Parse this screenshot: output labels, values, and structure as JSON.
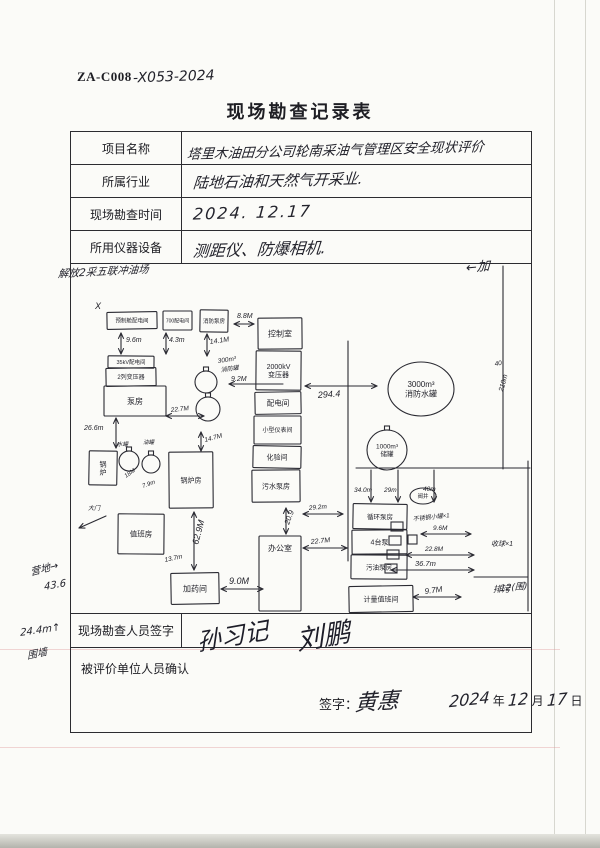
{
  "page": {
    "code_printed": "ZA-C008",
    "code_handwritten": "-X053-2024",
    "title": "现场勘查记录表"
  },
  "form": {
    "rows": [
      {
        "label": "项目名称",
        "value": "塔里木油田分公司轮南采油气管理区安全现状评价"
      },
      {
        "label": "所属行业",
        "value": "陆地石油和天然气开采业."
      },
      {
        "label": "现场勘查时间",
        "value": "2024. 12.17"
      },
      {
        "label": "所用仪器设备",
        "value": "测距仪、防爆相机."
      }
    ],
    "surveyor_row": {
      "label": "现场勘查人员签字",
      "signatures": [
        "孙习记",
        "刘鹏"
      ]
    },
    "confirm_row": {
      "label": "被评价单位人员确认",
      "sign_label": "签字：",
      "sign_name": "黄惠",
      "date": {
        "year": "2024",
        "year_suffix": "年",
        "month": "12",
        "month_suffix": "月",
        "day": "17",
        "day_suffix": "日"
      }
    }
  },
  "sketch": {
    "ink_color": "#2a2a32",
    "boxes": [
      {
        "x": 36,
        "y": 48,
        "w": 50,
        "h": 17,
        "l": [
          "预制舱配电间"
        ],
        "fs": 5.5
      },
      {
        "x": 92,
        "y": 47,
        "w": 29,
        "h": 19,
        "l": [
          "700配电间"
        ],
        "fs": 5
      },
      {
        "x": 129,
        "y": 46,
        "w": 28,
        "h": 22,
        "l": [
          "消防泵房"
        ],
        "fs": 5.5
      },
      {
        "x": 187,
        "y": 54,
        "w": 44,
        "h": 31,
        "l": [
          "控制室"
        ],
        "fs": 8
      },
      {
        "x": 185,
        "y": 87,
        "w": 45,
        "h": 39,
        "l": [
          "2000kV",
          "变压器"
        ],
        "fs": 7
      },
      {
        "x": 184,
        "y": 128,
        "w": 46,
        "h": 22,
        "l": [
          "配电间"
        ],
        "fs": 7.5
      },
      {
        "x": 183,
        "y": 152,
        "w": 47,
        "h": 28,
        "l": [
          "小型仪表间"
        ],
        "fs": 6
      },
      {
        "x": 182,
        "y": 182,
        "w": 48,
        "h": 22,
        "l": [
          "化验间"
        ],
        "fs": 7
      },
      {
        "x": 181,
        "y": 206,
        "w": 48,
        "h": 32,
        "l": [
          "污水泵房"
        ],
        "fs": 7
      },
      {
        "x": 37,
        "y": 92,
        "w": 46,
        "h": 12,
        "l": [
          "35kV配电间"
        ],
        "fs": 5.5
      },
      {
        "x": 35,
        "y": 104,
        "w": 50,
        "h": 18,
        "l": [
          "2列变压器"
        ],
        "fs": 6
      },
      {
        "x": 33,
        "y": 122,
        "w": 62,
        "h": 30,
        "l": [
          "泵房"
        ],
        "fs": 8
      },
      {
        "x": 18,
        "y": 187,
        "w": 28,
        "h": 34,
        "l": [
          "锅",
          "炉"
        ],
        "fs": 7
      },
      {
        "x": 98,
        "y": 188,
        "w": 44,
        "h": 56,
        "l": [
          "锅炉房"
        ],
        "fs": 7
      },
      {
        "x": 47,
        "y": 250,
        "w": 46,
        "h": 40,
        "l": [
          "值班房"
        ],
        "fs": 7.5
      },
      {
        "x": 100,
        "y": 309,
        "w": 48,
        "h": 31,
        "l": [
          "加药间"
        ],
        "fs": 8
      },
      {
        "x": 188,
        "y": 272,
        "w": 42,
        "h": 75,
        "l": [
          "办公室"
        ],
        "fs": 8,
        "ly": 287
      },
      {
        "x": 282,
        "y": 240,
        "w": 54,
        "h": 25,
        "l": [
          "循环泵房"
        ],
        "fs": 6.5
      },
      {
        "x": 281,
        "y": 266,
        "w": 55,
        "h": 24,
        "l": [
          "4台泵"
        ],
        "fs": 7
      },
      {
        "x": 280,
        "y": 291,
        "w": 56,
        "h": 24,
        "l": [
          "污油泵房"
        ],
        "fs": 6.5
      },
      {
        "x": 278,
        "y": 322,
        "w": 64,
        "h": 26,
        "l": [
          "计量值班间"
        ],
        "fs": 7
      }
    ],
    "circles": [
      {
        "cx": 135,
        "cy": 118,
        "r": 11
      },
      {
        "cx": 137,
        "cy": 145,
        "r": 12
      },
      {
        "cx": 58,
        "cy": 197,
        "r": 10
      },
      {
        "cx": 80,
        "cy": 200,
        "r": 9
      },
      {
        "cx": 316,
        "cy": 186,
        "r": 20,
        "l": [
          "1000m³",
          "储罐"
        ],
        "fs": 6.5
      }
    ],
    "ellipses": [
      {
        "cx": 350,
        "cy": 125,
        "rx": 33,
        "ry": 27,
        "l": [
          "3000m³",
          "消防水罐"
        ],
        "fs": 8
      },
      {
        "cx": 352,
        "cy": 232,
        "rx": 13,
        "ry": 8,
        "l": [
          "阀井"
        ],
        "fs": 5.5
      }
    ],
    "squares": [
      {
        "x": 320,
        "y": 258,
        "w": 12,
        "h": 9
      },
      {
        "x": 318,
        "y": 272,
        "w": 12,
        "h": 9
      },
      {
        "x": 316,
        "y": 286,
        "w": 12,
        "h": 9
      },
      {
        "x": 314,
        "y": 300,
        "w": 12,
        "h": 9
      },
      {
        "x": 337,
        "y": 271,
        "w": 9,
        "h": 9
      }
    ],
    "lines": [
      [
        [
          277,
          77
        ],
        [
          277,
          297
        ]
      ],
      [
        [
          285,
          204
        ],
        [
          459,
          204
        ]
      ],
      [
        [
          432,
          2
        ],
        [
          432,
          205
        ]
      ],
      [
        [
          457,
          197
        ],
        [
          457,
          347
        ]
      ],
      [
        [
          403,
          313
        ],
        [
          457,
          313
        ]
      ]
    ],
    "arrows": [
      {
        "x1": 50,
        "y1": 69,
        "x2": 50,
        "y2": 90,
        "h1": 1,
        "h2": 1
      },
      {
        "x1": 95,
        "y1": 69,
        "x2": 95,
        "y2": 90,
        "h1": 1,
        "h2": 1
      },
      {
        "x1": 136,
        "y1": 70,
        "x2": 136,
        "y2": 92,
        "h1": 1,
        "h2": 1
      },
      {
        "x1": 163,
        "y1": 60,
        "x2": 183,
        "y2": 60,
        "h1": 1,
        "h2": 1
      },
      {
        "x1": 212,
        "y1": 120,
        "x2": 158,
        "y2": 120,
        "h1": 0,
        "h2": 1
      },
      {
        "x1": 95,
        "y1": 152,
        "x2": 133,
        "y2": 152,
        "h1": 1,
        "h2": 1
      },
      {
        "x1": 45,
        "y1": 154,
        "x2": 45,
        "y2": 184,
        "h1": 1,
        "h2": 1
      },
      {
        "x1": 130,
        "y1": 168,
        "x2": 130,
        "y2": 187,
        "h1": 1,
        "h2": 1
      },
      {
        "x1": 123,
        "y1": 248,
        "x2": 123,
        "y2": 306,
        "h1": 1,
        "h2": 1
      },
      {
        "x1": 150,
        "y1": 325,
        "x2": 192,
        "y2": 325,
        "h1": 1,
        "h2": 1
      },
      {
        "x1": 215,
        "y1": 244,
        "x2": 215,
        "y2": 270,
        "h1": 1,
        "h2": 1
      },
      {
        "x1": 232,
        "y1": 250,
        "x2": 272,
        "y2": 250,
        "h1": 1,
        "h2": 1
      },
      {
        "x1": 232,
        "y1": 284,
        "x2": 276,
        "y2": 284,
        "h1": 1,
        "h2": 1
      },
      {
        "x1": 234,
        "y1": 122,
        "x2": 306,
        "y2": 122,
        "h1": 1,
        "h2": 1
      },
      {
        "x1": 300,
        "y1": 206,
        "x2": 300,
        "y2": 238,
        "h1": 0,
        "h2": 1
      },
      {
        "x1": 327,
        "y1": 206,
        "x2": 327,
        "y2": 238,
        "h1": 0,
        "h2": 1
      },
      {
        "x1": 363,
        "y1": 206,
        "x2": 363,
        "y2": 238,
        "h1": 0,
        "h2": 1
      },
      {
        "x1": 350,
        "y1": 270,
        "x2": 400,
        "y2": 270,
        "h1": 1,
        "h2": 1
      },
      {
        "x1": 335,
        "y1": 291,
        "x2": 403,
        "y2": 291,
        "h1": 1,
        "h2": 1
      },
      {
        "x1": 320,
        "y1": 306,
        "x2": 403,
        "y2": 306,
        "h1": 1,
        "h2": 1
      },
      {
        "x1": 342,
        "y1": 333,
        "x2": 390,
        "y2": 333,
        "h1": 1,
        "h2": 1
      },
      {
        "x1": 35,
        "y1": 252,
        "x2": 8,
        "y2": 264,
        "h1": 0,
        "h2": 1
      }
    ],
    "dims": [
      {
        "x": 55,
        "y": 78,
        "t": "9.6m",
        "fs": 7,
        "rot": 0
      },
      {
        "x": 98,
        "y": 78,
        "t": "4.3m",
        "fs": 7,
        "rot": 0
      },
      {
        "x": 139,
        "y": 80,
        "t": "14.1M",
        "fs": 7,
        "rot": -8
      },
      {
        "x": 166,
        "y": 54,
        "t": "8.8M",
        "fs": 7,
        "rot": 0
      },
      {
        "x": 147,
        "y": 99,
        "t": "300m³",
        "fs": 6.5,
        "rot": -8
      },
      {
        "x": 150,
        "y": 108,
        "t": "消防罐",
        "fs": 6,
        "rot": -8
      },
      {
        "x": 160,
        "y": 117,
        "t": "9.2M",
        "fs": 7,
        "rot": 0
      },
      {
        "x": 100,
        "y": 148,
        "t": "22.7M",
        "fs": 6.5,
        "rot": -6
      },
      {
        "x": 13,
        "y": 166,
        "t": "26.6m",
        "fs": 7,
        "rot": 0
      },
      {
        "x": 46,
        "y": 182,
        "t": "水罐",
        "fs": 5.5,
        "rot": 0
      },
      {
        "x": 72,
        "y": 180,
        "t": "油罐",
        "fs": 5.5,
        "rot": 0
      },
      {
        "x": 55,
        "y": 214,
        "t": "18M",
        "fs": 6,
        "rot": -35
      },
      {
        "x": 72,
        "y": 224,
        "t": "7.9m",
        "fs": 6,
        "rot": -20
      },
      {
        "x": 134,
        "y": 178,
        "t": "14.7M",
        "fs": 6.5,
        "rot": -15
      },
      {
        "x": 127,
        "y": 281,
        "t": "62.9M",
        "fs": 9,
        "rot": -75
      },
      {
        "x": 94,
        "y": 298,
        "t": "13.7m",
        "fs": 6.5,
        "rot": -12
      },
      {
        "x": 158,
        "y": 320,
        "t": "9.0M",
        "fs": 9,
        "rot": 0
      },
      {
        "x": 218,
        "y": 261,
        "t": "20.9",
        "fs": 7.5,
        "rot": -70
      },
      {
        "x": 238,
        "y": 246,
        "t": "29.2m",
        "fs": 6.5,
        "rot": -5
      },
      {
        "x": 240,
        "y": 280,
        "t": "22.7M",
        "fs": 7,
        "rot": -6
      },
      {
        "x": 247,
        "y": 134,
        "t": "294.4",
        "fs": 9,
        "rot": -4
      },
      {
        "x": 283,
        "y": 228,
        "t": "34.0m",
        "fs": 6.5,
        "rot": 0
      },
      {
        "x": 313,
        "y": 228,
        "t": "29m",
        "fs": 6.5,
        "rot": 0
      },
      {
        "x": 352,
        "y": 227,
        "t": "40m",
        "fs": 6.5,
        "rot": 0
      },
      {
        "x": 342,
        "y": 257,
        "t": "不锈钢小罐×1",
        "fs": 6,
        "rot": -6
      },
      {
        "x": 362,
        "y": 266,
        "t": "9.6M",
        "fs": 6.5,
        "rot": 0
      },
      {
        "x": 354,
        "y": 287,
        "t": "22.8M",
        "fs": 6.5,
        "rot": 0
      },
      {
        "x": 344,
        "y": 302,
        "t": "36.7m",
        "fs": 7.5,
        "rot": 0
      },
      {
        "x": 354,
        "y": 330,
        "t": "9.7M",
        "fs": 8,
        "rot": -8
      },
      {
        "x": 420,
        "y": 282,
        "t": "收球×1",
        "fs": 7,
        "rot": 0
      },
      {
        "x": 422,
        "y": 328,
        "t": "排污",
        "fs": 8.5,
        "rot": 0
      },
      {
        "x": 17,
        "y": 246,
        "t": "大门",
        "fs": 6,
        "rot": 0
      },
      {
        "x": 424,
        "y": 102,
        "t": "40",
        "fs": 6.5,
        "rot": -10
      },
      {
        "x": 432,
        "y": 128,
        "t": "210m",
        "fs": 7,
        "rot": -75
      },
      {
        "x": 24,
        "y": 45,
        "t": "X",
        "fs": 9,
        "rot": 0
      }
    ]
  },
  "margin_notes": [
    {
      "x": 58,
      "y": 264,
      "t": "解放2采五联冲油场",
      "fs": 10.5,
      "rot": -3
    },
    {
      "x": 30,
      "y": 560,
      "t": "营地→",
      "fs": 10,
      "rot": -15
    },
    {
      "x": 44,
      "y": 580,
      "t": "43.6",
      "fs": 10,
      "rot": -10
    },
    {
      "x": 20,
      "y": 625,
      "t": "24.4m↑",
      "fs": 10,
      "rot": -8
    },
    {
      "x": 27,
      "y": 645,
      "t": "围墙",
      "fs": 10,
      "rot": -12
    },
    {
      "x": 466,
      "y": 256,
      "t": "←加",
      "fs": 13,
      "rot": -5
    },
    {
      "x": 500,
      "y": 580,
      "t": "12(围)",
      "fs": 9,
      "rot": -5
    }
  ]
}
